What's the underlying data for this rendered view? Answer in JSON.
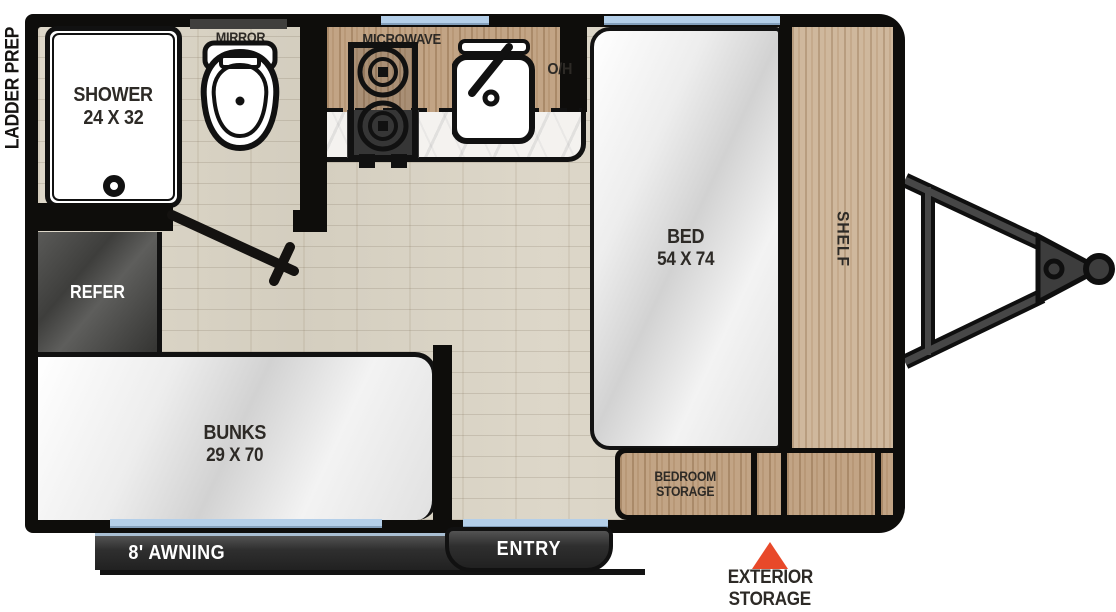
{
  "exterior": {
    "ladder_prep": "LADDER PREP",
    "awning": "8' AWNING",
    "entry": "ENTRY",
    "storage_marker_line1": "EXTERIOR",
    "storage_marker_line2": "STORAGE"
  },
  "bathroom": {
    "shower": "SHOWER",
    "shower_size": "24 X 32",
    "mirror": "MIRROR"
  },
  "kitchen": {
    "microwave": "MICROWAVE",
    "overhead": "O/H",
    "refer": "REFER"
  },
  "bedroom": {
    "bed": "BED",
    "bed_size": "54 X 74",
    "shelf": "SHELF",
    "storage_line1": "BEDROOM",
    "storage_line2": "STORAGE"
  },
  "bunks": {
    "label": "BUNKS",
    "size": "29 X 70"
  },
  "colors": {
    "wall": "#0e0d0b",
    "window_blue": "#b4cfe9",
    "floor_wood": "#d9d3c5",
    "cabinet_wood": "#c2a485",
    "shelf_wood": "#cfb89d",
    "refer_gray": "#4b4a48",
    "marker_orange": "#e8492a",
    "label_dark": "#2d2a26"
  }
}
